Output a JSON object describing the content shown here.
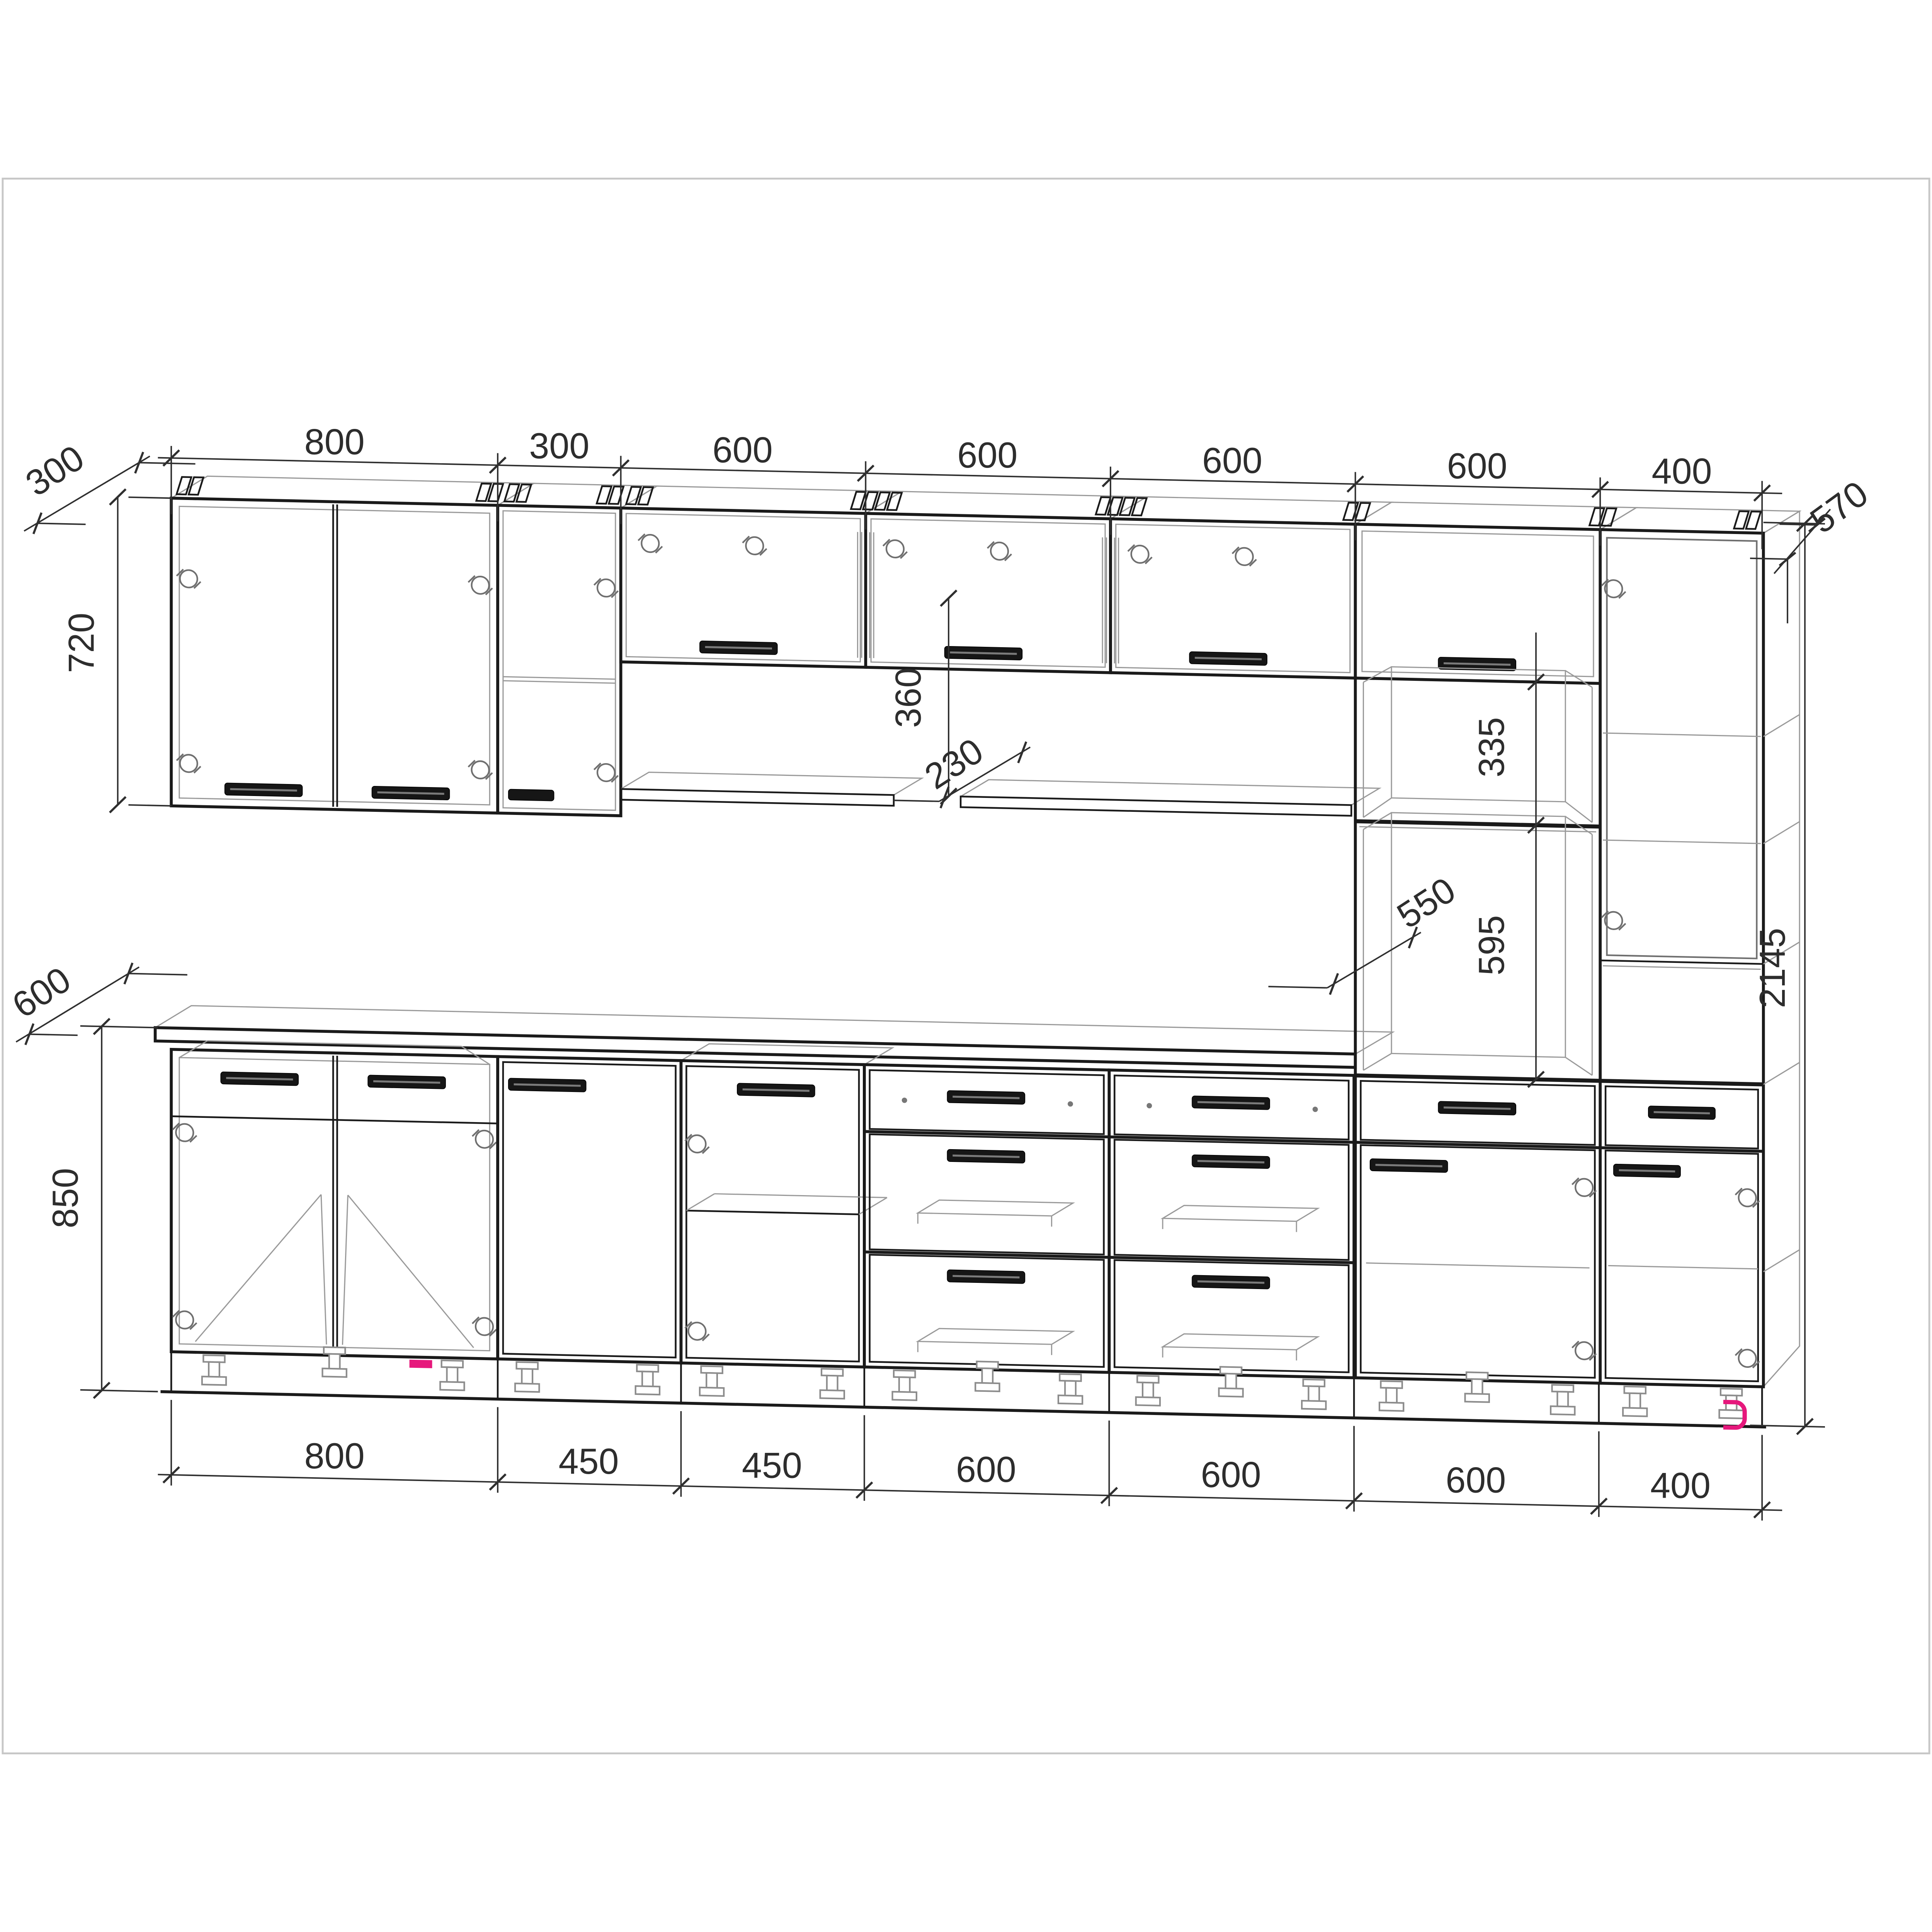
{
  "colors": {
    "background": "#ffffff",
    "line": "#1a1a1a",
    "secondary_line": "#9a9a9a",
    "dim_text": "#2d2d2d",
    "accent_pink": "#e6187c"
  },
  "dims": {
    "top": [
      "800",
      "300",
      "600",
      "600",
      "600",
      "600",
      "400"
    ],
    "bottom": [
      "800",
      "450",
      "450",
      "600",
      "600",
      "600",
      "400"
    ],
    "left_wall_depth": "300",
    "wall_cabinet_height": "720",
    "counter_depth": "600",
    "base_height": "850",
    "top_depth_right": "570",
    "total_height": "2145",
    "shelf_depth": "230",
    "shelf_offset": "360",
    "niche_height": "335",
    "niche_depth": "550",
    "oven_niche_height": "595"
  }
}
